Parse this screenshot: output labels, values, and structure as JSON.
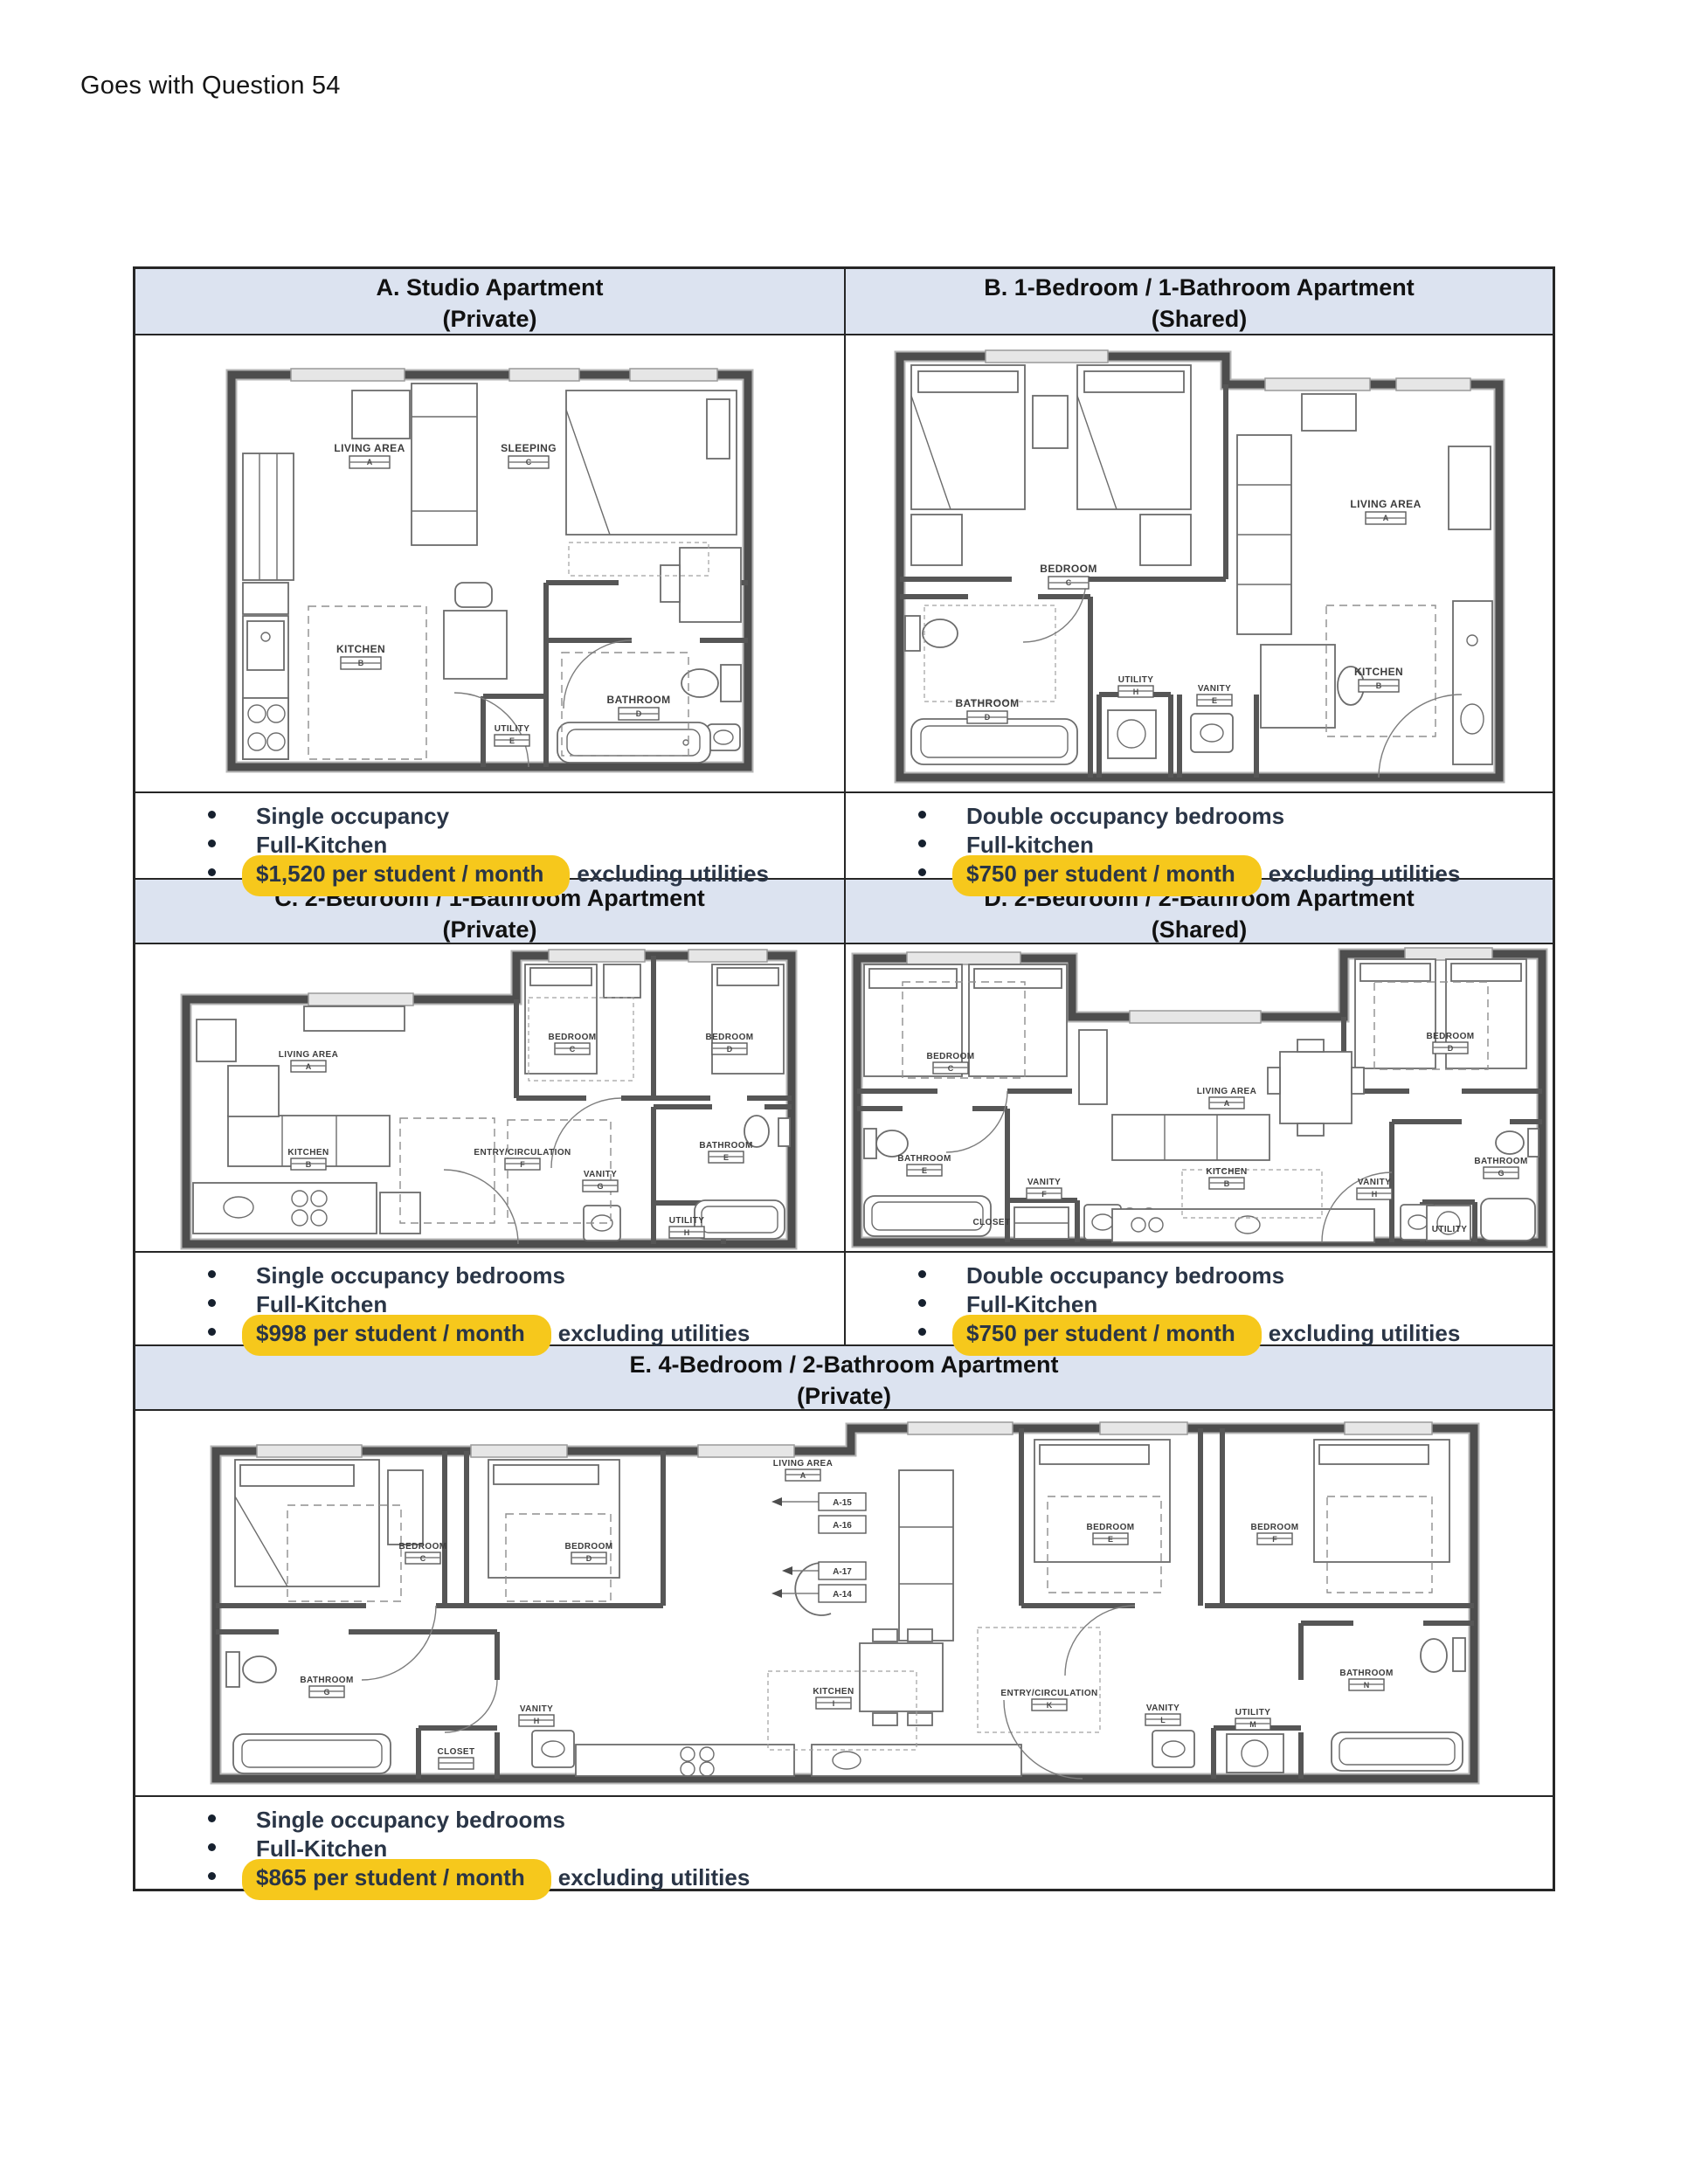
{
  "page": {
    "header_note": "Goes with Question 54"
  },
  "colors": {
    "highlight": "#F6C81C",
    "header_bg": "#DCE3F0",
    "table_border": "#262626"
  },
  "sections": {
    "a": {
      "title": "A. Studio Apartment",
      "subtitle": "(Private)",
      "bullet1": "Single occupancy",
      "bullet2": "Full-Kitchen",
      "price": "$1,520 per student / month",
      "price_rest": "excluding utilities"
    },
    "b": {
      "title": "B. 1-Bedroom / 1-Bathroom Apartment",
      "subtitle": "(Shared)",
      "bullet1": "Double occupancy bedrooms",
      "bullet2": "Full-kitchen",
      "price": "$750 per student / month",
      "price_rest": "excluding utilities"
    },
    "c": {
      "title": "C. 2-Bedroom / 1-Bathroom Apartment",
      "subtitle": "(Private)",
      "bullet1": "Single occupancy bedrooms",
      "bullet2": "Full-Kitchen",
      "price": "$998 per student / month",
      "price_rest": "excluding utilities"
    },
    "d": {
      "title": "D. 2-Bedroom / 2-Bathroom Apartment",
      "subtitle": "(Shared)",
      "bullet1": "Double occupancy bedrooms",
      "bullet2": "Full-Kitchen",
      "price": "$750 per student / month",
      "price_rest": "excluding utilities"
    },
    "e": {
      "title": "E. 4-Bedroom / 2-Bathroom Apartment",
      "subtitle": "(Private)",
      "bullet1": "Single occupancy bedrooms",
      "bullet2": "Full-Kitchen",
      "price": "$865 per student / month",
      "price_rest": "excluding utilities"
    }
  },
  "plans": {
    "a": {
      "living": "LIVING AREA",
      "living_tag": "A",
      "sleeping": "SLEEPING",
      "sleeping_tag": "C",
      "kitchen": "KITCHEN",
      "kitchen_tag": "B",
      "bathroom": "BATHROOM",
      "bathroom_tag": "D",
      "utility": "UTILITY",
      "utility_tag": "E"
    },
    "b": {
      "bedroom": "BEDROOM",
      "bedroom_tag": "C",
      "living": "LIVING AREA",
      "living_tag": "A",
      "kitchen": "KITCHEN",
      "kitchen_tag": "B",
      "bathroom": "BATHROOM",
      "bathroom_tag": "D",
      "vanity": "VANITY",
      "vanity_tag": "E",
      "utility": "UTILITY",
      "utility_tag": "H"
    },
    "c": {
      "living": "LIVING AREA",
      "living_tag": "A",
      "kitchen": "KITCHEN",
      "kitchen_tag": "B",
      "bedroom1": "BEDROOM",
      "bedroom1_tag": "C",
      "bedroom2": "BEDROOM",
      "bedroom2_tag": "D",
      "bathroom": "BATHROOM",
      "bathroom_tag": "E",
      "entry": "ENTRY/CIRCULATION",
      "entry_tag": "F",
      "vanity": "VANITY",
      "vanity_tag": "G",
      "utility": "UTILITY",
      "utility_tag": "H"
    },
    "d": {
      "bedroom1": "BEDROOM",
      "bedroom1_tag": "C",
      "bedroom2": "BEDROOM",
      "bedroom2_tag": "D",
      "living": "LIVING AREA",
      "living_tag": "A",
      "kitchen": "KITCHEN",
      "kitchen_tag": "B",
      "bathroom1": "BATHROOM",
      "bathroom1_tag": "E",
      "vanity1": "VANITY",
      "vanity1_tag": "F",
      "closet": "CLOSET",
      "vanity2": "VANITY",
      "vanity2_tag": "H",
      "bathroom2": "BATHROOM",
      "bathroom2_tag": "G",
      "utility": "UTILITY",
      "utility_tag": "M"
    },
    "e": {
      "living": "LIVING AREA",
      "living_tag": "A",
      "bedroom1": "BEDROOM",
      "bedroom1_tag": "C",
      "bedroom2": "BEDROOM",
      "bedroom2_tag": "D",
      "bedroom3": "BEDROOM",
      "bedroom3_tag": "E",
      "bedroom4": "BEDROOM",
      "bedroom4_tag": "F",
      "bathroom1": "BATHROOM",
      "bathroom1_tag": "G",
      "vanity1": "VANITY",
      "vanity1_tag": "H",
      "closet": "CLOSET",
      "kitchen": "KITCHEN",
      "kitchen_tag": "I",
      "entry": "ENTRY/CIRCULATION",
      "entry_tag": "K",
      "vanity2": "VANITY",
      "vanity2_tag": "L",
      "utility": "UTILITY",
      "utility_tag": "M",
      "bathroom2": "BATHROOM",
      "bathroom2_tag": "N",
      "callout1": "A-15",
      "callout2": "A-16",
      "callout3": "A-17",
      "callout4": "A-14"
    }
  }
}
